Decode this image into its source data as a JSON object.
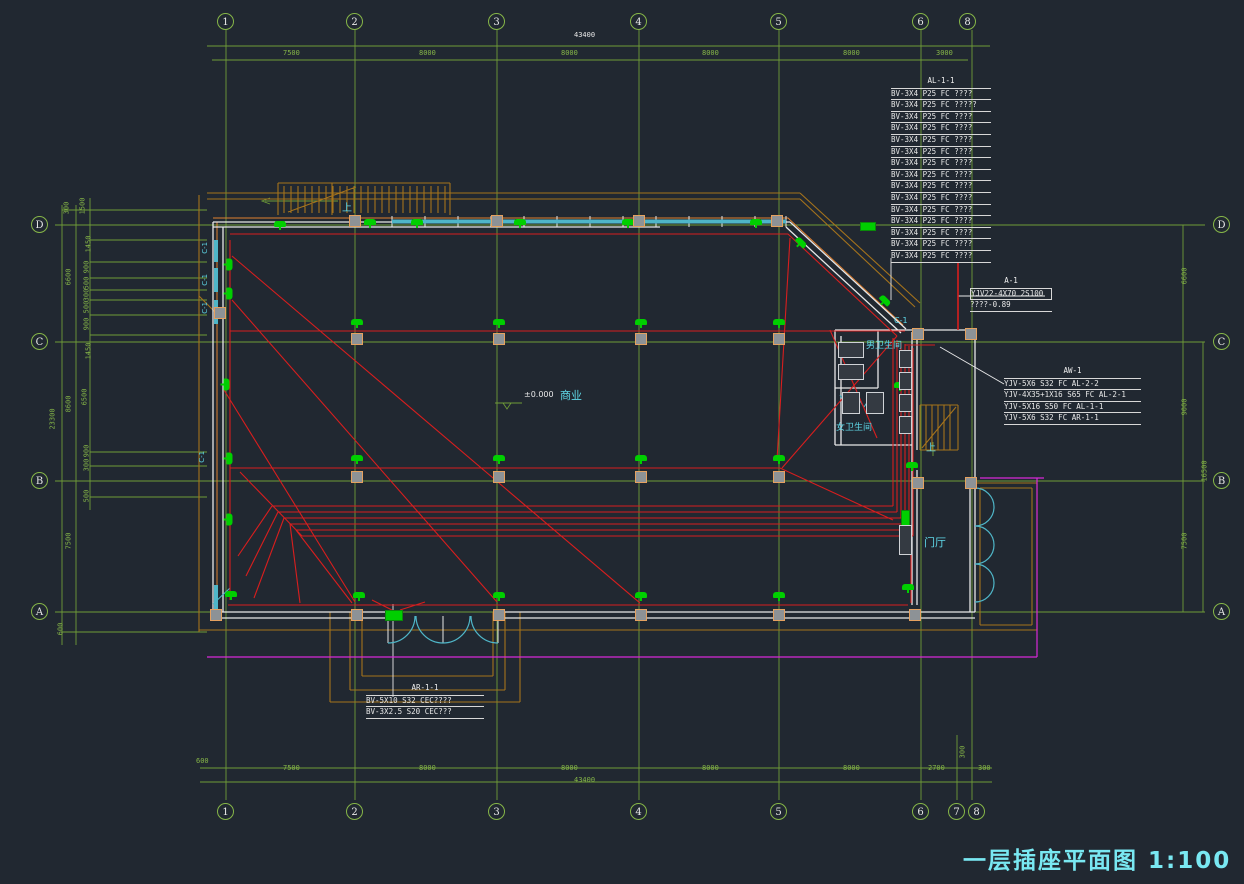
{
  "title_block": {
    "text": "一层插座平面图 1:100"
  },
  "colors": {
    "background": "#212831",
    "axis_green": "#86b648",
    "wire_red": "#d81e1e",
    "device_green": "#00cf00",
    "wall_white": "#e8e8e8",
    "window_cyan": "#4fb6c8",
    "canopy_brown": "#a5731c",
    "magenta": "#d829d8",
    "label_cyan": "#5fd8e8",
    "title_cyan": "#79e8f2"
  },
  "axis_bubbles": [
    {
      "t": "1",
      "x": 226,
      "y": 22
    },
    {
      "t": "2",
      "x": 355,
      "y": 22
    },
    {
      "t": "3",
      "x": 497,
      "y": 22
    },
    {
      "t": "4",
      "x": 639,
      "y": 22
    },
    {
      "t": "5",
      "x": 779,
      "y": 22
    },
    {
      "t": "6",
      "x": 921,
      "y": 22
    },
    {
      "t": "8",
      "x": 968,
      "y": 22
    },
    {
      "t": "1",
      "x": 226,
      "y": 812
    },
    {
      "t": "2",
      "x": 355,
      "y": 812
    },
    {
      "t": "3",
      "x": 497,
      "y": 812
    },
    {
      "t": "4",
      "x": 639,
      "y": 812
    },
    {
      "t": "5",
      "x": 779,
      "y": 812
    },
    {
      "t": "6",
      "x": 921,
      "y": 812
    },
    {
      "t": "7",
      "x": 957,
      "y": 812
    },
    {
      "t": "8",
      "x": 977,
      "y": 812
    },
    {
      "t": "D",
      "x": 40,
      "y": 225
    },
    {
      "t": "C",
      "x": 40,
      "y": 342
    },
    {
      "t": "B",
      "x": 40,
      "y": 481
    },
    {
      "t": "A",
      "x": 40,
      "y": 612
    },
    {
      "t": "D",
      "x": 1222,
      "y": 225
    },
    {
      "t": "C",
      "x": 1222,
      "y": 342
    },
    {
      "t": "B",
      "x": 1222,
      "y": 481
    },
    {
      "t": "A",
      "x": 1222,
      "y": 612
    }
  ],
  "dim_labels": [
    {
      "t": "43400",
      "x": 574,
      "y": 31,
      "c": "#e8e8e8"
    },
    {
      "t": "7500",
      "x": 283,
      "y": 49
    },
    {
      "t": "8000",
      "x": 419,
      "y": 49
    },
    {
      "t": "8000",
      "x": 561,
      "y": 49
    },
    {
      "t": "8000",
      "x": 702,
      "y": 49
    },
    {
      "t": "8000",
      "x": 843,
      "y": 49
    },
    {
      "t": "3000",
      "x": 936,
      "y": 49
    },
    {
      "t": "600",
      "x": 196,
      "y": 757
    },
    {
      "t": "7500",
      "x": 283,
      "y": 764
    },
    {
      "t": "8000",
      "x": 419,
      "y": 764
    },
    {
      "t": "8000",
      "x": 561,
      "y": 764
    },
    {
      "t": "8000",
      "x": 702,
      "y": 764
    },
    {
      "t": "8000",
      "x": 843,
      "y": 764
    },
    {
      "t": "2700",
      "x": 928,
      "y": 764
    },
    {
      "t": "300",
      "x": 956,
      "y": 748,
      "r": -90
    },
    {
      "t": "300",
      "x": 978,
      "y": 764
    },
    {
      "t": "43400",
      "x": 574,
      "y": 776
    },
    {
      "t": "300",
      "x": 60,
      "y": 204,
      "r": -90
    },
    {
      "t": "1500",
      "x": 74,
      "y": 202,
      "r": -90
    },
    {
      "t": "1450",
      "x": 80,
      "y": 240,
      "r": -90
    },
    {
      "t": "900",
      "x": 80,
      "y": 263,
      "r": -90
    },
    {
      "t": "500",
      "x": 80,
      "y": 279,
      "r": -90
    },
    {
      "t": "300",
      "x": 80,
      "y": 291,
      "r": -90
    },
    {
      "t": "500",
      "x": 80,
      "y": 303,
      "r": -90
    },
    {
      "t": "900",
      "x": 80,
      "y": 320,
      "r": -90
    },
    {
      "t": "1450",
      "x": 80,
      "y": 347,
      "r": -90
    },
    {
      "t": "6600",
      "x": 60,
      "y": 273,
      "r": -90
    },
    {
      "t": "23300",
      "x": 42,
      "y": 415,
      "r": -90
    },
    {
      "t": "8600",
      "x": 60,
      "y": 400,
      "r": -90
    },
    {
      "t": "6500",
      "x": 76,
      "y": 393,
      "r": -90
    },
    {
      "t": "900",
      "x": 80,
      "y": 447,
      "r": -90
    },
    {
      "t": "300",
      "x": 80,
      "y": 461,
      "r": -90
    },
    {
      "t": "500",
      "x": 80,
      "y": 492,
      "r": -90
    },
    {
      "t": "7500",
      "x": 60,
      "y": 537,
      "r": -90
    },
    {
      "t": "600",
      "x": 54,
      "y": 625,
      "r": -90
    },
    {
      "t": "6600",
      "x": 1176,
      "y": 272,
      "r": -90
    },
    {
      "t": "9000",
      "x": 1176,
      "y": 403,
      "r": -90
    },
    {
      "t": "16500",
      "x": 1194,
      "y": 467,
      "r": -90
    },
    {
      "t": "7500",
      "x": 1176,
      "y": 537,
      "r": -90
    }
  ],
  "text_labels": [
    {
      "t": "商业",
      "x": 560,
      "y": 390,
      "c": "#5fd8e8",
      "s": 11
    },
    {
      "t": "门厅",
      "x": 924,
      "y": 537,
      "c": "#5fd8e8",
      "s": 11
    },
    {
      "t": "男卫生间",
      "x": 866,
      "y": 342,
      "c": "#5fd8e8",
      "s": 9
    },
    {
      "t": "女卫生间",
      "x": 836,
      "y": 424,
      "c": "#5fd8e8",
      "s": 9
    },
    {
      "t": "上",
      "x": 342,
      "y": 203,
      "c": "#5fd8e8",
      "s": 10
    },
    {
      "t": "上",
      "x": 926,
      "y": 443,
      "c": "#5fd8e8",
      "s": 10
    },
    {
      "t": "±0.000",
      "x": 524,
      "y": 391,
      "c": "#e8e8e8",
      "s": 8
    },
    {
      "t": "C-1",
      "x": 200,
      "y": 244,
      "c": "#5fd8e8",
      "s": 7,
      "r": -90
    },
    {
      "t": "C-1",
      "x": 200,
      "y": 276,
      "c": "#5fd8e8",
      "s": 7,
      "r": -90
    },
    {
      "t": "C-1",
      "x": 200,
      "y": 304,
      "c": "#5fd8e8",
      "s": 7,
      "r": -90
    },
    {
      "t": "C-1",
      "x": 197,
      "y": 453,
      "c": "#5fd8e8",
      "s": 7,
      "r": -90
    },
    {
      "t": "C-1",
      "x": 894,
      "y": 317,
      "c": "#5fd8e8",
      "s": 8
    }
  ],
  "annotations": [
    {
      "title": "AL-1-1",
      "x": 891,
      "y": 76,
      "w": 100,
      "box_first": false,
      "lines": [
        "BV-3X4 P25 FC ????",
        "BV-3X4 P25 FC ?????",
        "BV-3X4 P25 FC ????",
        "BV-3X4 P25 FC ????",
        "BV-3X4 P25 FC ????",
        "BV-3X4 P25 FC ????",
        "BV-3X4 P25 FC ????",
        "BV-3X4 P25 FC ????",
        "BV-3X4 P25 FC ????",
        "BV-3X4 P25 FC ????",
        "BV-3X4 P25 FC ????",
        "BV-3X4 P25 FC ????",
        "BV-3X4 P25 FC ????",
        "BV-3X4 P25 FC ????",
        "BV-3X4 P25 FC ????"
      ]
    },
    {
      "title": "A-1",
      "x": 970,
      "y": 276,
      "w": 82,
      "box_first": true,
      "lines": [
        "YJV22-4X70 2S100",
        "????-0.89"
      ]
    },
    {
      "title": "AW-1",
      "x": 1004,
      "y": 366,
      "w": 137,
      "box_first": false,
      "lines": [
        "YJV-5X6 S32 FC AL-2-2",
        "YJV-4X35+1X16 S65 FC AL-2-1",
        "YJV-5X16 S50 FC AL-1-1",
        "YJV-5X6 S32 FC AR-1-1"
      ]
    },
    {
      "title": "AR-1-1",
      "x": 366,
      "y": 683,
      "w": 118,
      "box_first": false,
      "lines": [
        "BV-5X10 S32  CEC????",
        "BV-3X2.5  S20  CEC???"
      ]
    }
  ],
  "symbols": {
    "sockets": [
      {
        "x": 280,
        "y": 229
      },
      {
        "x": 370,
        "y": 227
      },
      {
        "x": 417,
        "y": 227
      },
      {
        "x": 520,
        "y": 227
      },
      {
        "x": 628,
        "y": 227
      },
      {
        "x": 756,
        "y": 227
      },
      {
        "x": 800,
        "y": 247,
        "r": 45
      },
      {
        "x": 884,
        "y": 305,
        "r": 45
      },
      {
        "x": 357,
        "y": 327
      },
      {
        "x": 499,
        "y": 327
      },
      {
        "x": 641,
        "y": 327
      },
      {
        "x": 779,
        "y": 327
      },
      {
        "x": 357,
        "y": 463
      },
      {
        "x": 499,
        "y": 463
      },
      {
        "x": 641,
        "y": 463
      },
      {
        "x": 779,
        "y": 463
      },
      {
        "x": 231,
        "y": 599
      },
      {
        "x": 359,
        "y": 600
      },
      {
        "x": 499,
        "y": 600
      },
      {
        "x": 641,
        "y": 600
      },
      {
        "x": 779,
        "y": 600
      },
      {
        "x": 908,
        "y": 592
      },
      {
        "x": 228,
        "y": 268,
        "r": 90
      },
      {
        "x": 228,
        "y": 297,
        "r": 90
      },
      {
        "x": 225,
        "y": 388,
        "r": 90
      },
      {
        "x": 228,
        "y": 462,
        "r": 90
      },
      {
        "x": 228,
        "y": 523,
        "r": 90
      },
      {
        "x": 852,
        "y": 352
      },
      {
        "x": 900,
        "y": 390
      },
      {
        "x": 912,
        "y": 470
      }
    ],
    "columns": [
      {
        "x": 355,
        "y": 221
      },
      {
        "x": 497,
        "y": 221
      },
      {
        "x": 639,
        "y": 221
      },
      {
        "x": 777,
        "y": 221
      },
      {
        "x": 357,
        "y": 339
      },
      {
        "x": 499,
        "y": 339
      },
      {
        "x": 641,
        "y": 339
      },
      {
        "x": 779,
        "y": 339
      },
      {
        "x": 357,
        "y": 477
      },
      {
        "x": 499,
        "y": 477
      },
      {
        "x": 641,
        "y": 477
      },
      {
        "x": 779,
        "y": 477
      },
      {
        "x": 357,
        "y": 615
      },
      {
        "x": 499,
        "y": 615
      },
      {
        "x": 641,
        "y": 615
      },
      {
        "x": 779,
        "y": 615
      },
      {
        "x": 915,
        "y": 615
      },
      {
        "x": 918,
        "y": 483
      },
      {
        "x": 971,
        "y": 483
      },
      {
        "x": 918,
        "y": 334
      },
      {
        "x": 971,
        "y": 334
      },
      {
        "x": 220,
        "y": 313
      },
      {
        "x": 216,
        "y": 615
      }
    ],
    "panels": [
      {
        "x": 860,
        "y": 222,
        "w": 16,
        "h": 9
      },
      {
        "x": 901,
        "y": 510,
        "w": 9,
        "h": 26
      },
      {
        "x": 385,
        "y": 610,
        "w": 18,
        "h": 11
      }
    ],
    "fixtures": [
      {
        "x": 838,
        "y": 342,
        "w": 26,
        "h": 16
      },
      {
        "x": 838,
        "y": 364,
        "w": 26,
        "h": 16
      },
      {
        "x": 842,
        "y": 392,
        "w": 18,
        "h": 22
      },
      {
        "x": 866,
        "y": 392,
        "w": 18,
        "h": 22
      },
      {
        "x": 899,
        "y": 350,
        "w": 13,
        "h": 18
      },
      {
        "x": 899,
        "y": 372,
        "w": 13,
        "h": 18
      },
      {
        "x": 899,
        "y": 394,
        "w": 13,
        "h": 18
      },
      {
        "x": 899,
        "y": 416,
        "w": 13,
        "h": 18
      },
      {
        "x": 899,
        "y": 525,
        "w": 13,
        "h": 30
      }
    ]
  }
}
